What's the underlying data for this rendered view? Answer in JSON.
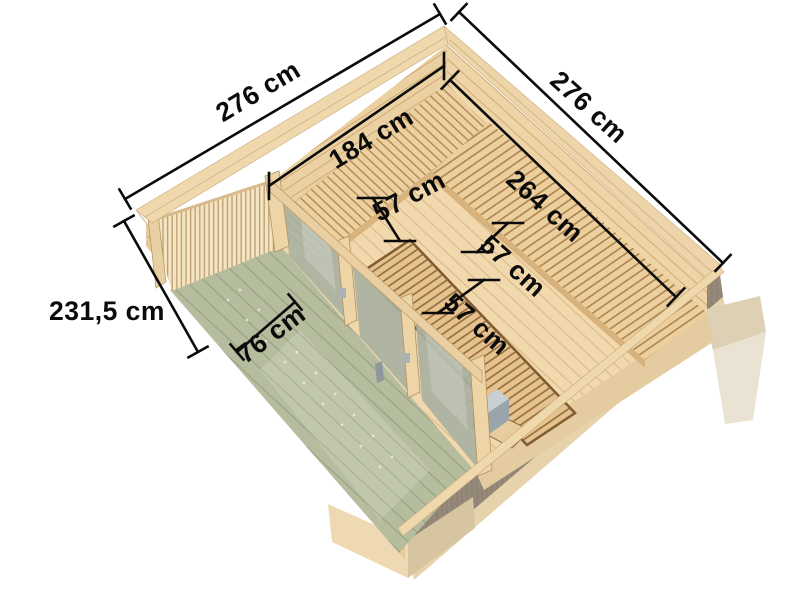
{
  "dimensions": {
    "outer_left": "276 cm",
    "outer_right": "276 cm",
    "inner_width": "184 cm",
    "inner_depth": "264 cm",
    "bench_back": "57 cm",
    "bench_middle": "57 cm",
    "bench_front": "57 cm",
    "height": "231,5 cm",
    "terrace_width": "76 cm"
  },
  "colors": {
    "background": "#ffffff",
    "dimension_ink": "#0b0b0b",
    "wood_rim": "#f0d8ad",
    "wood_wall": "#ebd1a2",
    "bench_wood": "#eccf9d",
    "bench_middle_wood": "#e6c28f",
    "terrace_green": "#b6bd9e",
    "glass": "#a9b2a2",
    "heater_body": "#343c42",
    "heater_top": "#c8d0d4"
  }
}
